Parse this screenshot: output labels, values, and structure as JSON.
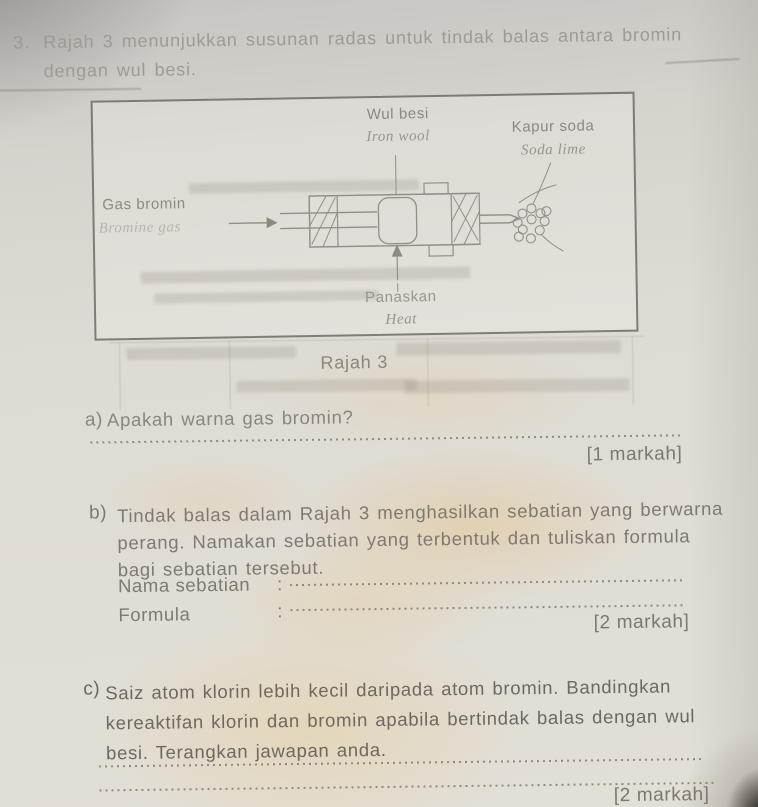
{
  "page": {
    "number": "3.",
    "intro": [
      "Rajah 3 menunjukkan susunan radas untuk tindak balas antara bromin",
      "dengan wul besi."
    ]
  },
  "figure": {
    "caption": "Rajah 3",
    "labels": {
      "iron_wool": {
        "ms": "Wul besi",
        "en": "Iron wool"
      },
      "soda_lime": {
        "ms": "Kapur soda",
        "en": "Soda lime"
      },
      "bromine_gas": {
        "ms": "Gas bromin",
        "en": "Bromine gas"
      },
      "heat": {
        "ms": "Panaskan",
        "en": "Heat"
      }
    }
  },
  "questions": {
    "a": {
      "label": "a)",
      "lines": [
        "Apakah warna gas bromin?"
      ],
      "marks": "[1 markah]"
    },
    "b": {
      "label": "b)",
      "lines": [
        "Tindak balas dalam Rajah 3 menghasilkan sebatian yang berwarna",
        "perang. Namakan sebatian yang terbentuk dan tuliskan formula",
        "bagi sebatian tersebut."
      ],
      "fields": [
        {
          "name": "Nama sebatian",
          "colon": ":"
        },
        {
          "name": "Formula",
          "colon": ":"
        }
      ],
      "marks": "[2 markah]"
    },
    "c": {
      "label": "c)",
      "lines": [
        "Saiz atom klorin lebih kecil daripada atom bromin. Bandingkan",
        "kereaktifan klorin dan bromin apabila bertindak balas dengan wul",
        "besi. Terangkan jawapan anda."
      ],
      "marks": "[2 markah]"
    }
  },
  "colors": {
    "paper": "#dedbd4",
    "ink_dark": "#6d6861",
    "ink_medium": "#7f7971",
    "ink_faded": "#9e9b94",
    "diagram_ink": "#8d8980",
    "warm_tint": "#e6cf9e",
    "shadow_corner": "#3a352e"
  }
}
